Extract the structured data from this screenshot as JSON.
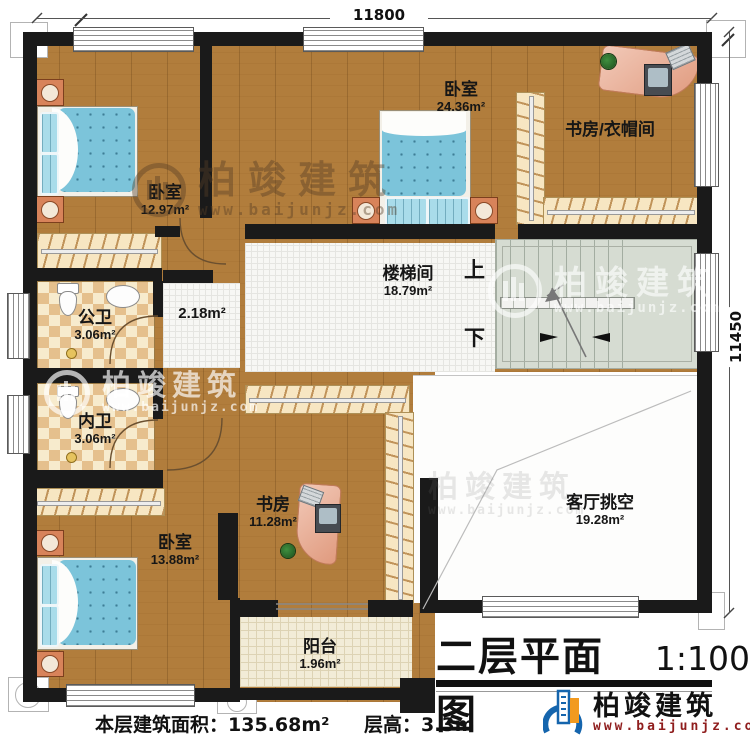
{
  "title": {
    "text": "二层平面图",
    "scale": "1:100"
  },
  "dimensions": {
    "top": "11800",
    "right": "11450"
  },
  "rooms": {
    "bedroom_top_left": {
      "name": "卧室",
      "area": "12.97m²"
    },
    "bedroom_top": {
      "name": "卧室",
      "area": "24.36m²"
    },
    "study_cloakroom": {
      "name": "书房/衣帽间"
    },
    "stairwell": {
      "name": "楼梯间",
      "area": "18.79m²"
    },
    "hall": {
      "area": "2.18m²"
    },
    "public_bath": {
      "name": "公卫",
      "area": "3.06m²"
    },
    "private_bath": {
      "name": "内卫",
      "area": "3.06m²"
    },
    "study": {
      "name": "书房",
      "area": "11.28m²"
    },
    "bedroom_bottom_left": {
      "name": "卧室",
      "area": "13.88m²"
    },
    "living_void": {
      "name": "客厅挑空",
      "area": "19.28m²"
    },
    "balcony": {
      "name": "阳台",
      "area": "1.96m²"
    }
  },
  "stairs": {
    "up": "上",
    "down": "下"
  },
  "footer": {
    "area_label": "本层建筑面积：",
    "area_value": "135.68m²",
    "height_label": "层高：",
    "height_value": "3.3m"
  },
  "watermark": {
    "brand": "柏竣建筑",
    "url": "www.baijunjz.com"
  },
  "colors": {
    "wall": "#1a1a1a",
    "wood": "#b17d3c",
    "mattress": "#7cc4da",
    "logo_blue": "#1565ad",
    "logo_orange": "#f29a1f"
  }
}
